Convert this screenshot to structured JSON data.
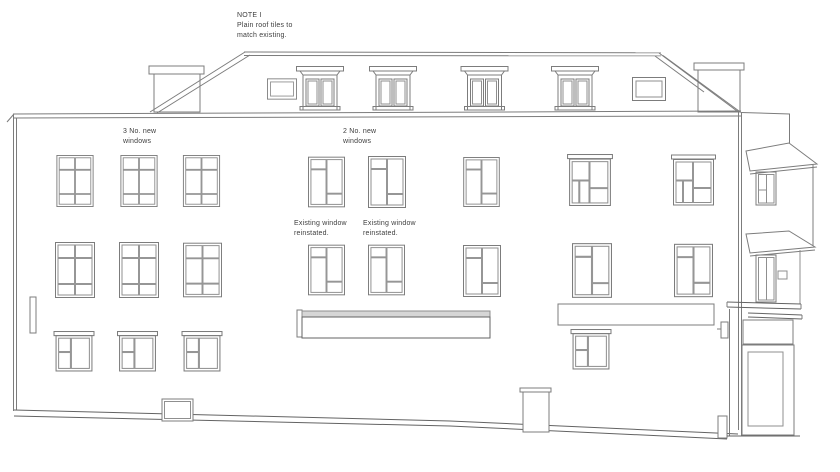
{
  "note": {
    "line1": "NOTE I",
    "line2": "Plain roof tiles to",
    "line3": "match existing."
  },
  "labels": {
    "left_new_windows": {
      "line1": "3 No. new",
      "line2": "windows"
    },
    "centre_new_windows": {
      "line1": "2 No. new",
      "line2": "windows"
    },
    "reinstated_left": {
      "line1": "Existing window",
      "line2": "reinstated."
    },
    "reinstated_right": {
      "line1": "Existing window",
      "line2": "reinstated."
    }
  },
  "colors": {
    "background": "#ffffff",
    "line": "#7c7c7c",
    "line_dark": "#636363",
    "shade": "#d6d6d6",
    "text": "#3e3e3e"
  }
}
